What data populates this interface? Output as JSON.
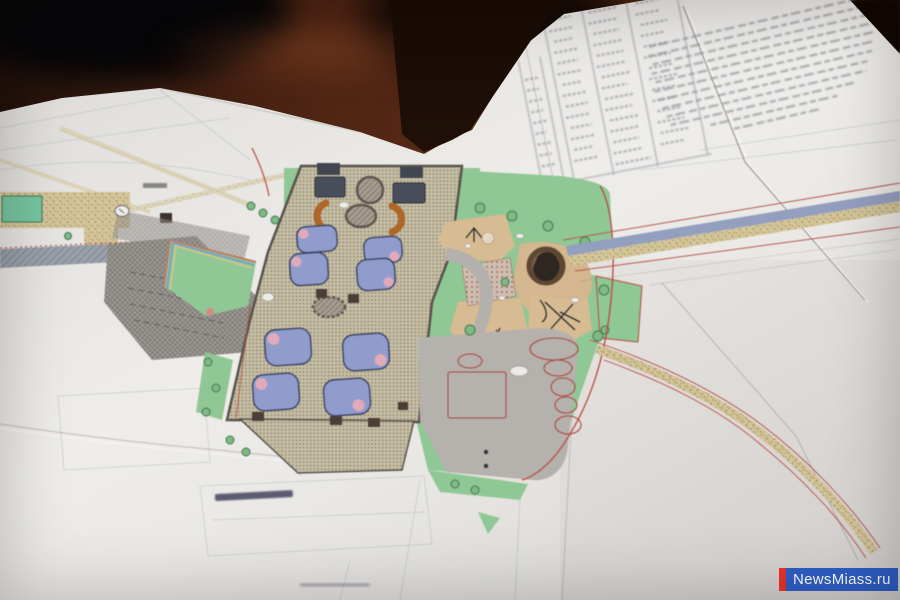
{
  "meta": {
    "type": "photograph",
    "subject": "Landscape-architecture park plans (blueprints) spread out on a dark wooden table, photographed at an angle"
  },
  "watermark": {
    "text": "NewsMiass.ru",
    "text_color": "#ffffff",
    "bar_color": "#e8332a",
    "background_color": "#2e5ec6"
  },
  "palette": {
    "table_wood": "#4a2212",
    "paper": "#e9e7e4",
    "lawn_green": "#8ccb92",
    "aqua_green": "#72c8a0",
    "promenade_tan": "#c9c0a3",
    "flowerbed_blue": "#8e9dd3",
    "flowerbed_pink": "#e9aabb",
    "pavilion_slate": "#474c5c",
    "bench_orange": "#b5651d",
    "playground_sand": "#dcbd8f",
    "mound_brown": "#7b5b40",
    "plaza_gray": "#b7b3ae",
    "parking_gray": "#a09c97",
    "road_asphalt": "#93a0c4",
    "road_sand": "#d8c795",
    "boundary_red": "#c2473c",
    "pencil_gray": "#8087a0",
    "blurred_text_ink": "#8f8f99"
  },
  "plan_features": {
    "flower_beds": 8,
    "fountain_circles": 3,
    "pavilion_rects": 4,
    "plaza_circles": 5,
    "orange_benches": 2,
    "roads": 3,
    "trees_approx": 20,
    "text_legible": false
  },
  "documents": {
    "notes_sheet_text_lines": 12,
    "table_sheet_columns": 3,
    "table_sheet_rows": 15
  }
}
